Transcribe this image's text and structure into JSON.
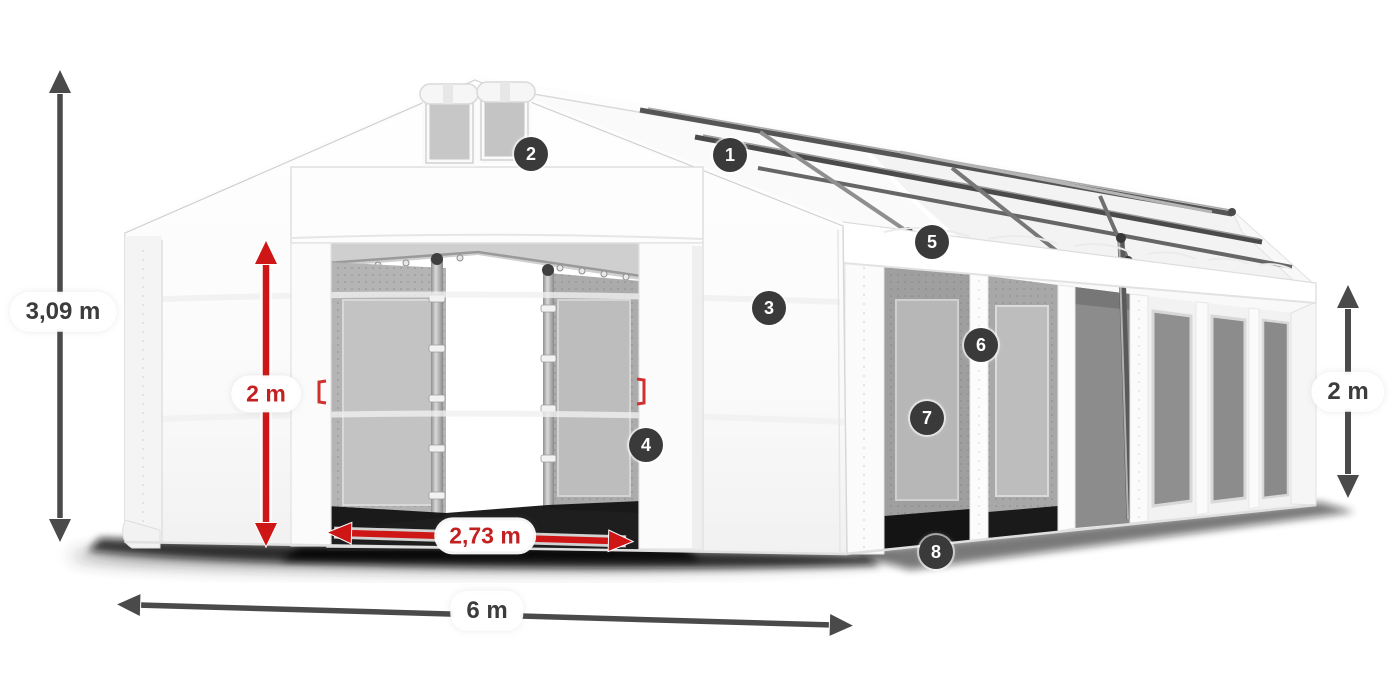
{
  "diagram": {
    "background": "#ffffff",
    "dimension_labels": [
      {
        "id": "total-height",
        "text": "3,09 m",
        "color": "gray"
      },
      {
        "id": "door-height",
        "text": "2 m",
        "color": "red"
      },
      {
        "id": "door-width",
        "text": "2,73 m",
        "color": "red"
      },
      {
        "id": "front-width",
        "text": "6 m",
        "color": "gray"
      },
      {
        "id": "side-height",
        "text": "2 m",
        "color": "gray"
      }
    ],
    "callouts": [
      {
        "number": "1"
      },
      {
        "number": "2"
      },
      {
        "number": "3"
      },
      {
        "number": "4"
      },
      {
        "number": "5"
      },
      {
        "number": "6"
      },
      {
        "number": "7"
      },
      {
        "number": "8"
      }
    ],
    "colors": {
      "dimension_red": "#c32121",
      "dimension_gray": "#3c3c3c",
      "arrow_gray": "#4a4a4a",
      "badge_background": "#3a3a3a",
      "badge_text": "#ffffff"
    }
  }
}
